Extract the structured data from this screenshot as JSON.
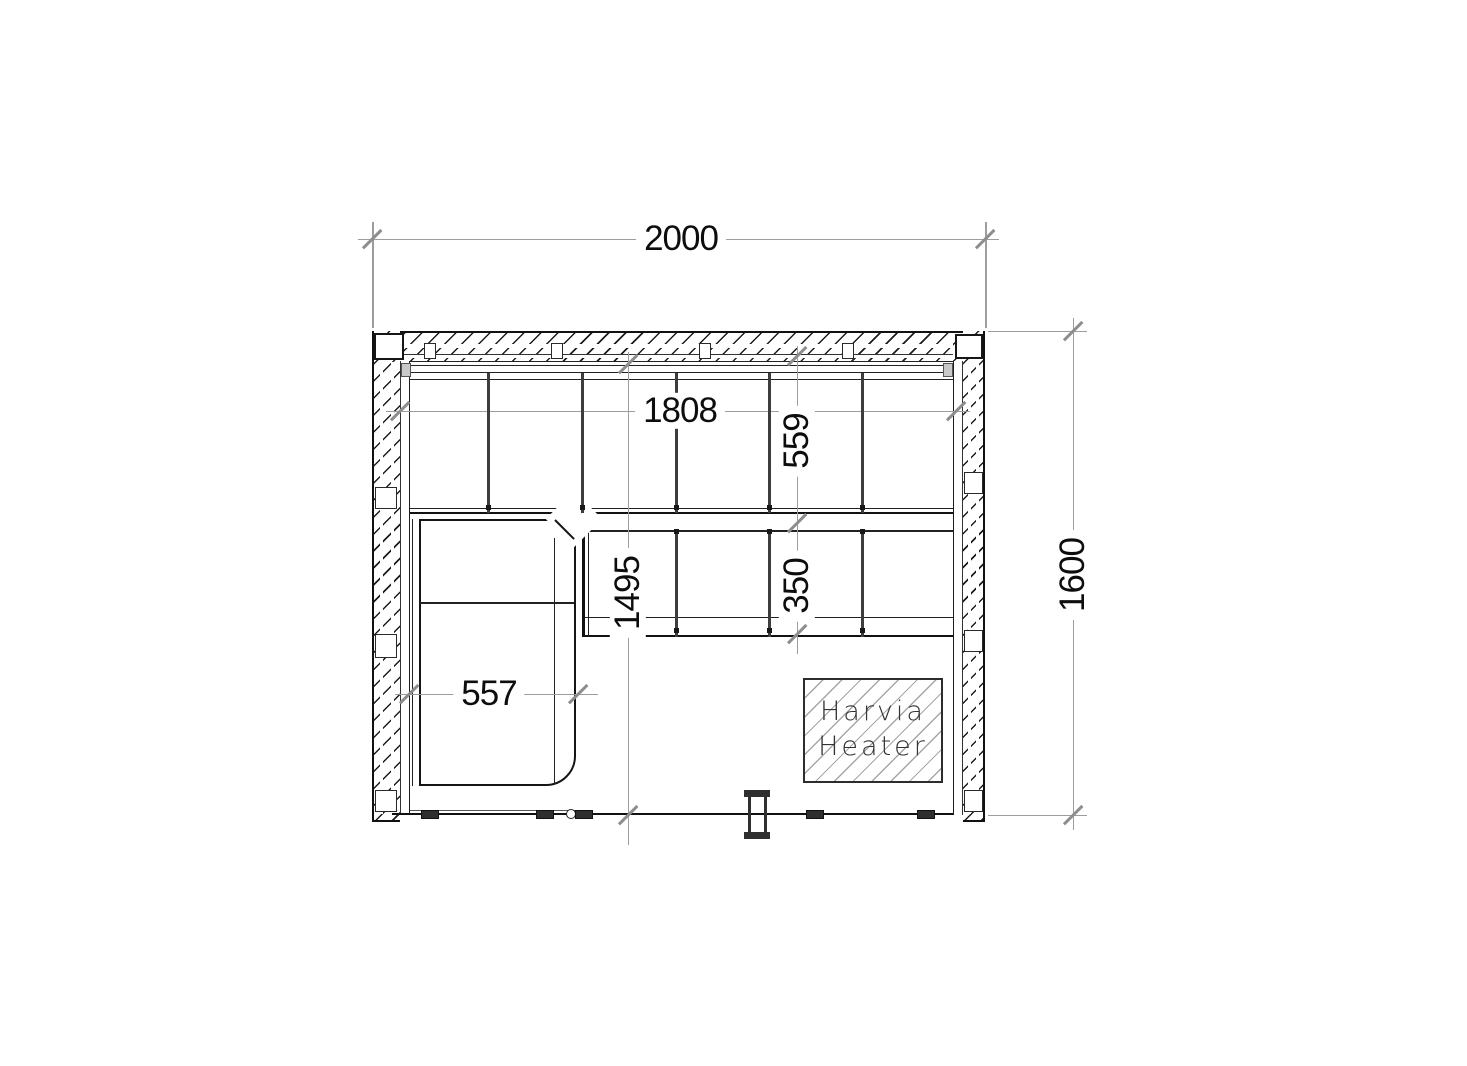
{
  "dimensions": {
    "overall_width": "2000",
    "overall_depth": "1600",
    "bench_run_width": "1808",
    "upper_bench_depth": "559",
    "lower_bench_depth": "350",
    "interior_depth": "1495",
    "side_bench_width": "557"
  },
  "heater_label": {
    "line1": "Harvia",
    "line2": "Heater"
  }
}
